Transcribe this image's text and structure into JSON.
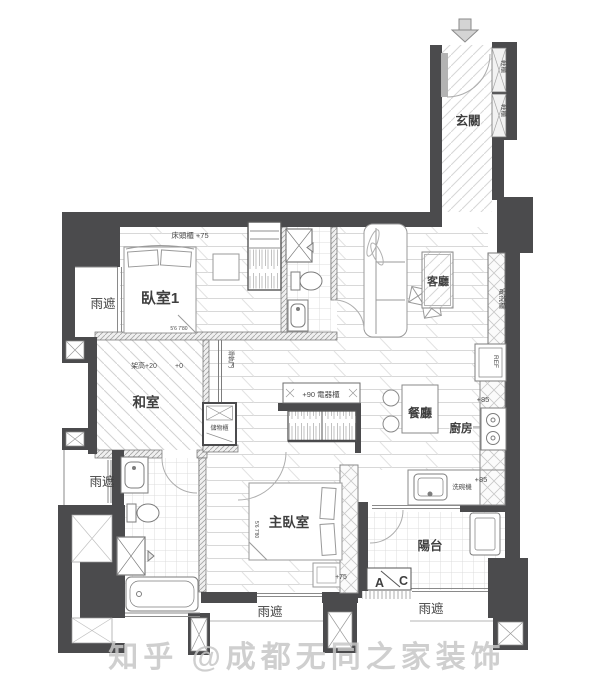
{
  "watermark": "知乎 @成都无同之家装饰",
  "colors": {
    "wall": "#4b4b4d",
    "label_text": "#3f3f3f",
    "watermark": "#c7c7c7"
  },
  "entry": {
    "label": "玄關",
    "shoe_cabinet_upper": "鞋櫃",
    "shoe_cabinet_lower": "鞋櫃"
  },
  "living": {
    "label": "客廳",
    "tv_cabinet": "電視櫃"
  },
  "bedroom1": {
    "label": "臥室1",
    "headboard_cabinet": "床頭櫃 +75",
    "closet_dim": "5'6 7'80"
  },
  "tatami": {
    "label": "和室",
    "raised_level": "架高+20",
    "floor_level": "+0",
    "sliding_door": "滑軌門",
    "storage_cabinet": "儲物櫃"
  },
  "dining": {
    "label": "餐廳",
    "appliance_cabinet": "+90 電器櫃"
  },
  "kitchen": {
    "label": "廚房",
    "fridge": "REF",
    "counter_level_upper": "+85",
    "counter_level_lower": "+85",
    "dishwasher": "洗碗機"
  },
  "master_bedroom": {
    "label": "主臥室",
    "platform_level": "+75",
    "bed_dim": "5'6 7'80"
  },
  "balcony": {
    "label": "陽台",
    "section_mark_a": "A",
    "section_mark_c": "C"
  },
  "canopies": {
    "upper_left": "雨遮",
    "lower_left": "雨遮",
    "bottom_center": "雨遮",
    "bottom_right": "雨遮"
  }
}
